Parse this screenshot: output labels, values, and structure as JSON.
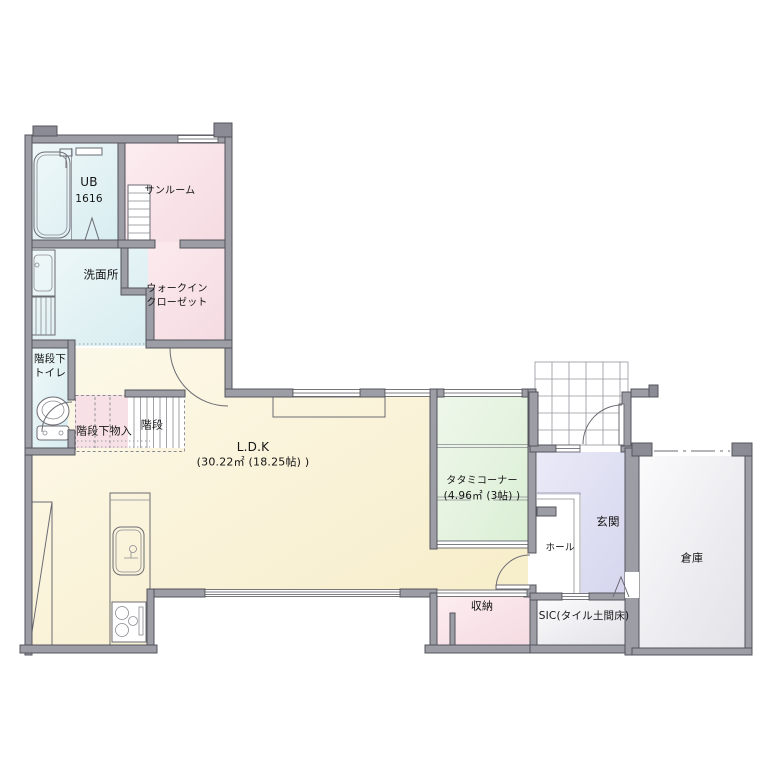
{
  "plan": {
    "title": "1F floor plan",
    "rooms": {
      "ub": {
        "name": "UB",
        "size": "1616"
      },
      "sunroom": {
        "name": "サンルーム"
      },
      "washroom": {
        "name": "洗面所"
      },
      "walk_in_closet": {
        "line1": "ウォークイン",
        "line2": "クローゼット"
      },
      "toilet_under_stairs": {
        "line1": "階段下",
        "line2": "トイレ"
      },
      "under_stair_storage": {
        "name": "階段下物入"
      },
      "stairs": {
        "name": "階段"
      },
      "ldk": {
        "name": "L.D.K",
        "area": "(30.22㎡ (18.25帖) )"
      },
      "tatami_corner": {
        "name": "タタミコーナー",
        "area": "(4.96㎡ (3帖) )"
      },
      "hall": {
        "name": "ホール"
      },
      "entrance": {
        "name": "玄関"
      },
      "warehouse": {
        "name": "倉庫"
      },
      "storage": {
        "name": "収納"
      },
      "sic": {
        "name": "SIC(タイル土間床)"
      }
    },
    "colors": {
      "wall": "#9d9da5",
      "wet_area_blue": "#e2f1f4",
      "closet_pink": "#f9e3e8",
      "ldk_yellow": "#faf2d7",
      "tatami_green": "#e4f2de",
      "entrance_lavender": "#dfdff2",
      "storage_gray": "#efeff2"
    }
  }
}
